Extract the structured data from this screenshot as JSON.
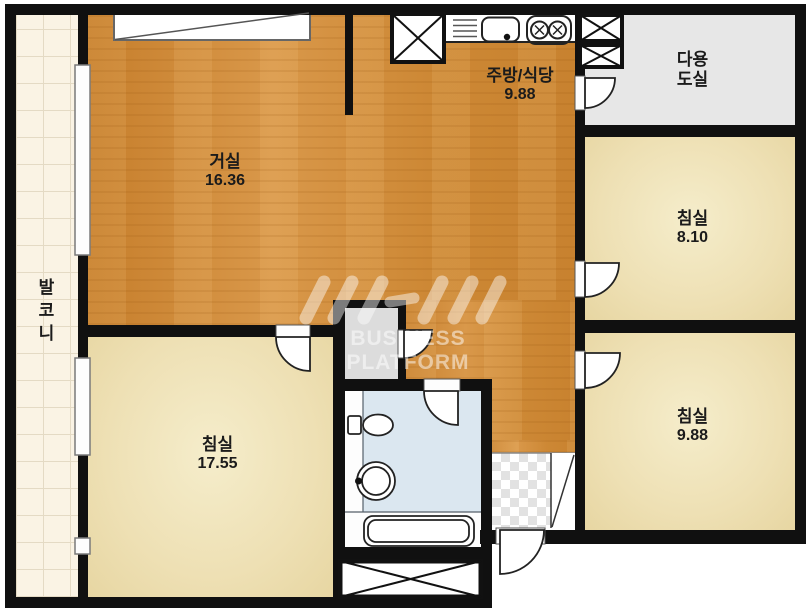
{
  "floorplan": {
    "balcony": {
      "label": "발코니"
    },
    "living_room": {
      "label": "거실",
      "area": "16.36"
    },
    "kitchen_dining": {
      "label": "주방/식당",
      "area": "9.88"
    },
    "utility_room": {
      "label": "다용도실",
      "label_line1": "다용",
      "label_line2": "도실"
    },
    "bedroom_top_right": {
      "label": "침실",
      "area": "8.10"
    },
    "bedroom_bottom_right": {
      "label": "침실",
      "area": "9.88"
    },
    "bedroom_left": {
      "label": "침실",
      "area": "17.55"
    },
    "watermark": {
      "brand": "NHN",
      "subtitle": "BUSINESS PLATFORM"
    },
    "colors": {
      "wood_floor": "#cf8a38",
      "bedroom_floor": "#eee0b4",
      "bathroom_floor": "#dbe7f0",
      "utility_floor": "#e7e7e7",
      "balcony_floor": "#faf3e4",
      "entry_checker": "#e2e2e2",
      "wall": "#101010"
    }
  }
}
